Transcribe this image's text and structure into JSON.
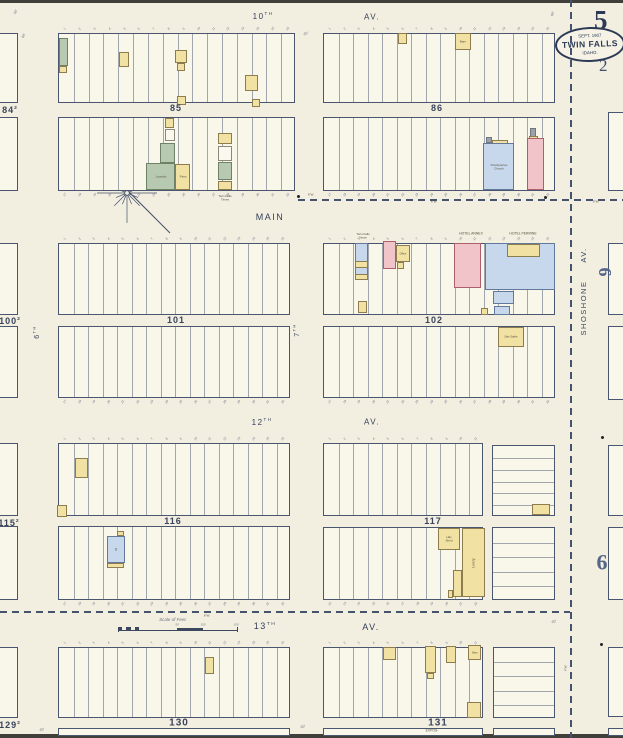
{
  "page": {
    "bg": "#f3efe0",
    "block_fill": "#f9f6ea",
    "ink": "#46536e",
    "sheet_number": "5",
    "secondary_number": "2",
    "badge": {
      "date": "SEPT. 1907",
      "city": "TWIN FALLS",
      "state": "IDAHO."
    }
  },
  "palette": {
    "fills": {
      "yellow": "#f1e2a4",
      "pink": "#f1c4c9",
      "blue": "#c8d8ec",
      "green": "#b8c9b2",
      "white": "#fbf9ef",
      "gray": "#9aa2aa"
    },
    "borders": {
      "yellow": "#8d7c4e",
      "pink": "#ad5f6d",
      "blue": "#62799c",
      "green": "#6f8268",
      "white": "#8a8a7a",
      "gray": "#70777e"
    }
  },
  "streets": [
    {
      "t": "10",
      "sup": "TH",
      "x": 263,
      "y": 17,
      "s": 8
    },
    {
      "t": "AV.",
      "x": 372,
      "y": 18,
      "s": 8
    },
    {
      "t": "MAIN",
      "x": 270,
      "y": 217,
      "s": 9
    },
    {
      "t": "12",
      "sup": "TH",
      "x": 262,
      "y": 423,
      "s": 8
    },
    {
      "t": "AV.",
      "x": 372,
      "y": 423,
      "s": 8
    },
    {
      "t": "13",
      "sup": "TH",
      "x": 265,
      "y": 626,
      "s": 9
    },
    {
      "t": "AV.",
      "x": 371,
      "y": 627,
      "s": 9
    },
    {
      "t": "SHOSHONE",
      "x": 584,
      "y": 308,
      "s": 7.5,
      "r": -90
    },
    {
      "t": "AV.",
      "x": 584,
      "y": 255,
      "s": 7.5,
      "r": -90
    },
    {
      "t": "6",
      "sup": "TH",
      "x": 37,
      "y": 332,
      "s": 7,
      "r": -90
    },
    {
      "t": "7",
      "sup": "TH",
      "x": 297,
      "y": 330,
      "s": 7,
      "r": -90
    }
  ],
  "blocks": [
    {
      "id": "84-sliver-upper",
      "x": -8,
      "y": 33,
      "w": 26,
      "h": 70,
      "lots": 0
    },
    {
      "id": "84-sliver-lower",
      "x": -8,
      "y": 117,
      "w": 26,
      "h": 74,
      "lots": 0
    },
    {
      "id": "85-upper",
      "x": 58,
      "y": 33,
      "w": 237,
      "h": 70,
      "lots": 16,
      "ticks": "top",
      "tickStart": 1
    },
    {
      "id": "85-lower",
      "x": 58,
      "y": 117,
      "w": 237,
      "h": 74,
      "lots": 16,
      "ticks": "bottom",
      "tickStart": 17
    },
    {
      "id": "86-upper",
      "x": 323,
      "y": 33,
      "w": 232,
      "h": 70,
      "lots": 16,
      "ticks": "top",
      "tickStart": 1
    },
    {
      "id": "86-lower",
      "x": 323,
      "y": 117,
      "w": 232,
      "h": 74,
      "lots": 16,
      "ticks": "bottom",
      "tickStart": 17
    },
    {
      "id": "100-sliver-upper",
      "x": -8,
      "y": 243,
      "w": 26,
      "h": 72,
      "lots": 0
    },
    {
      "id": "100-sliver-lower",
      "x": -8,
      "y": 326,
      "w": 26,
      "h": 72,
      "lots": 0
    },
    {
      "id": "101-upper",
      "x": 58,
      "y": 243,
      "w": 232,
      "h": 72,
      "lots": 16,
      "ticks": "top",
      "tickStart": 1
    },
    {
      "id": "101-lower",
      "x": 58,
      "y": 326,
      "w": 232,
      "h": 72,
      "lots": 16,
      "ticks": "bottom",
      "tickStart": 17
    },
    {
      "id": "102-upper",
      "x": 323,
      "y": 243,
      "w": 232,
      "h": 72,
      "lots": 16,
      "ticks": "top",
      "tickStart": 1
    },
    {
      "id": "102-lower",
      "x": 323,
      "y": 326,
      "w": 232,
      "h": 72,
      "lots": 16,
      "ticks": "bottom",
      "tickStart": 17
    },
    {
      "id": "115-sliver-upper",
      "x": -8,
      "y": 443,
      "w": 26,
      "h": 73,
      "lots": 0
    },
    {
      "id": "115-sliver-lower",
      "x": -8,
      "y": 526,
      "w": 26,
      "h": 74,
      "lots": 0
    },
    {
      "id": "116-upper",
      "x": 58,
      "y": 443,
      "w": 232,
      "h": 73,
      "lots": 16,
      "ticks": "top",
      "tickStart": 1
    },
    {
      "id": "116-lower",
      "x": 58,
      "y": 526,
      "w": 232,
      "h": 74,
      "lots": 16,
      "ticks": "bottom",
      "tickStart": 17
    },
    {
      "id": "117-upper-west",
      "x": 323,
      "y": 443,
      "w": 160,
      "h": 73,
      "lots": 11,
      "ticks": "top",
      "tickStart": 1
    },
    {
      "id": "117-upper-east",
      "x": 492,
      "y": 445,
      "w": 63,
      "h": 71,
      "lots": 6,
      "dir": "h"
    },
    {
      "id": "117-lower-west",
      "x": 323,
      "y": 527,
      "w": 160,
      "h": 73,
      "lots": 11,
      "ticks": "bottom",
      "tickStart": 12
    },
    {
      "id": "117-lower-east",
      "x": 492,
      "y": 527,
      "w": 63,
      "h": 73,
      "lots": 5,
      "dir": "h"
    },
    {
      "id": "129-sliver",
      "x": -8,
      "y": 647,
      "w": 26,
      "h": 71,
      "lots": 0
    },
    {
      "id": "130",
      "x": 58,
      "y": 647,
      "w": 232,
      "h": 71,
      "lots": 16,
      "ticks": "top",
      "tickStart": 1
    },
    {
      "id": "130-strip",
      "x": 58,
      "y": 728,
      "w": 232,
      "h": 8,
      "lots": 0
    },
    {
      "id": "131-west",
      "x": 323,
      "y": 647,
      "w": 160,
      "h": 71,
      "lots": 11,
      "ticks": "top",
      "tickStart": 1
    },
    {
      "id": "131-east",
      "x": 493,
      "y": 647,
      "w": 62,
      "h": 71,
      "lots": 5,
      "dir": "h"
    },
    {
      "id": "131-strip-west",
      "x": 323,
      "y": 728,
      "w": 160,
      "h": 8,
      "lots": 0
    },
    {
      "id": "131-strip-east",
      "x": 493,
      "y": 728,
      "w": 62,
      "h": 8,
      "lots": 0
    },
    {
      "id": "east-1",
      "x": 608,
      "y": 112,
      "w": 23,
      "h": 79,
      "lots": 0
    },
    {
      "id": "east-2",
      "x": 608,
      "y": 243,
      "w": 23,
      "h": 72,
      "lots": 0
    },
    {
      "id": "east-3",
      "x": 608,
      "y": 326,
      "w": 23,
      "h": 74,
      "lots": 0
    },
    {
      "id": "east-4",
      "x": 608,
      "y": 445,
      "w": 23,
      "h": 71,
      "lots": 0
    },
    {
      "id": "east-5",
      "x": 608,
      "y": 527,
      "w": 23,
      "h": 73,
      "lots": 0
    },
    {
      "id": "east-6",
      "x": 608,
      "y": 647,
      "w": 23,
      "h": 70,
      "lots": 0
    },
    {
      "id": "east-strip",
      "x": 608,
      "y": 728,
      "w": 23,
      "h": 8,
      "lots": 0
    }
  ],
  "block_labels": [
    {
      "t": "85",
      "x": 176,
      "y": 108,
      "s": 9
    },
    {
      "t": "86",
      "x": 437,
      "y": 108,
      "s": 9
    },
    {
      "t": "101",
      "x": 176,
      "y": 320,
      "s": 9
    },
    {
      "t": "102",
      "x": 434,
      "y": 320,
      "s": 9
    },
    {
      "t": "116",
      "x": 173,
      "y": 521,
      "s": 9
    },
    {
      "t": "117",
      "x": 433,
      "y": 521,
      "s": 9
    },
    {
      "t": "130",
      "x": 179,
      "y": 723,
      "s": 10
    },
    {
      "t": "131",
      "x": 438,
      "y": 723,
      "s": 10
    },
    {
      "t": "84",
      "sub": "2",
      "x": 10,
      "y": 110,
      "s": 9
    },
    {
      "t": "100",
      "sub": "2",
      "x": 10,
      "y": 321,
      "s": 9
    },
    {
      "t": "115",
      "sub": "2",
      "x": 9,
      "y": 523,
      "s": 9
    },
    {
      "t": "129",
      "sub": "2",
      "x": 10,
      "y": 725,
      "s": 9
    },
    {
      "t": "6",
      "x": 605,
      "y": 272,
      "s": 18,
      "r": 90,
      "serif": 1,
      "light": 1
    },
    {
      "t": "6",
      "x": 602,
      "y": 563,
      "s": 22,
      "serif": 1,
      "light": 1
    }
  ],
  "buildings": [
    {
      "x": 59,
      "y": 38,
      "w": 9,
      "h": 28,
      "c": "green"
    },
    {
      "x": 59,
      "y": 66,
      "w": 8,
      "h": 7,
      "c": "yellow"
    },
    {
      "x": 119,
      "y": 52,
      "w": 10,
      "h": 15,
      "c": "yellow"
    },
    {
      "x": 175,
      "y": 50,
      "w": 12,
      "h": 13,
      "c": "yellow"
    },
    {
      "x": 177,
      "y": 63,
      "w": 8,
      "h": 8,
      "c": "yellow"
    },
    {
      "x": 245,
      "y": 75,
      "w": 13,
      "h": 16,
      "c": "yellow"
    },
    {
      "x": 177,
      "y": 96,
      "w": 9,
      "h": 9,
      "c": "yellow",
      "cr": 1
    },
    {
      "x": 252,
      "y": 99,
      "w": 8,
      "h": 8,
      "c": "yellow",
      "cr": 1
    },
    {
      "x": 165,
      "y": 118,
      "w": 9,
      "h": 10,
      "c": "yellow",
      "cr": 1
    },
    {
      "x": 165,
      "y": 129,
      "w": 10,
      "h": 12,
      "c": "white"
    },
    {
      "x": 160,
      "y": 143,
      "w": 15,
      "h": 20,
      "c": "green"
    },
    {
      "x": 146,
      "y": 163,
      "w": 29,
      "h": 27,
      "c": "green",
      "lb": "Laundry",
      "ls": 3
    },
    {
      "x": 175,
      "y": 164,
      "w": 15,
      "h": 26,
      "c": "yellow",
      "lb": "Paint",
      "ls": 3
    },
    {
      "x": 218,
      "y": 133,
      "w": 14,
      "h": 11,
      "c": "yellow"
    },
    {
      "x": 218,
      "y": 146,
      "w": 14,
      "h": 15,
      "c": "white"
    },
    {
      "x": 218,
      "y": 162,
      "w": 14,
      "h": 18,
      "c": "green"
    },
    {
      "x": 218,
      "y": 181,
      "w": 14,
      "h": 9,
      "c": "yellow"
    },
    {
      "x": 398,
      "y": 33,
      "w": 9,
      "h": 11,
      "c": "yellow"
    },
    {
      "x": 455,
      "y": 33,
      "w": 16,
      "h": 17,
      "c": "yellow",
      "lb": "Barn",
      "ls": 3
    },
    {
      "x": 486,
      "y": 137,
      "w": 6,
      "h": 6,
      "c": "gray"
    },
    {
      "x": 492,
      "y": 140,
      "w": 16,
      "h": 4,
      "c": "yellow"
    },
    {
      "x": 483,
      "y": 143,
      "w": 31,
      "h": 47,
      "c": "blue",
      "lb": "Presbyterian\nChurch",
      "ls": 3
    },
    {
      "x": 530,
      "y": 128,
      "w": 6,
      "h": 10,
      "c": "gray"
    },
    {
      "x": 529,
      "y": 136,
      "w": 9,
      "h": 4,
      "c": "yellow"
    },
    {
      "x": 527,
      "y": 138,
      "w": 17,
      "h": 52,
      "c": "pink"
    },
    {
      "x": 355,
      "y": 243,
      "w": 13,
      "h": 36,
      "c": "blue"
    },
    {
      "x": 355,
      "y": 261,
      "w": 13,
      "h": 7,
      "c": "yellow"
    },
    {
      "x": 355,
      "y": 274,
      "w": 13,
      "h": 6,
      "c": "yellow"
    },
    {
      "x": 358,
      "y": 301,
      "w": 9,
      "h": 12,
      "c": "yellow"
    },
    {
      "x": 383,
      "y": 241,
      "w": 13,
      "h": 28,
      "c": "pink"
    },
    {
      "x": 396,
      "y": 245,
      "w": 14,
      "h": 17,
      "c": "yellow",
      "lb": "Office",
      "ls": 2.6
    },
    {
      "x": 397,
      "y": 262,
      "w": 7,
      "h": 7,
      "c": "yellow"
    },
    {
      "x": 454,
      "y": 243,
      "w": 27,
      "h": 45,
      "c": "pink"
    },
    {
      "x": 485,
      "y": 243,
      "w": 70,
      "h": 47,
      "c": "blue"
    },
    {
      "x": 507,
      "y": 244,
      "w": 33,
      "h": 13,
      "c": "yellow"
    },
    {
      "x": 493,
      "y": 291,
      "w": 21,
      "h": 13,
      "c": "blue"
    },
    {
      "x": 494,
      "y": 306,
      "w": 16,
      "h": 9,
      "c": "blue"
    },
    {
      "x": 481,
      "y": 308,
      "w": 7,
      "h": 7,
      "c": "yellow"
    },
    {
      "x": 498,
      "y": 327,
      "w": 26,
      "h": 20,
      "c": "yellow",
      "lb": "Sale Stable",
      "ls": 2.6
    },
    {
      "x": 75,
      "y": 458,
      "w": 13,
      "h": 20,
      "c": "yellow"
    },
    {
      "x": 57,
      "y": 505,
      "w": 10,
      "h": 12,
      "c": "yellow",
      "cr": 1
    },
    {
      "x": 117,
      "y": 531,
      "w": 7,
      "h": 5,
      "c": "yellow"
    },
    {
      "x": 107,
      "y": 536,
      "w": 18,
      "h": 27,
      "c": "blue",
      "lb": "D",
      "ls": 3.5
    },
    {
      "x": 107,
      "y": 563,
      "w": 17,
      "h": 5,
      "c": "yellow"
    },
    {
      "x": 532,
      "y": 504,
      "w": 18,
      "h": 11,
      "c": "yellow"
    },
    {
      "x": 438,
      "y": 528,
      "w": 22,
      "h": 22,
      "c": "yellow",
      "lb": "Hay\nShed",
      "ls": 3
    },
    {
      "x": 462,
      "y": 528,
      "w": 23,
      "h": 69,
      "c": "yellow",
      "cr": 1,
      "lb": "Livery",
      "ls": 3.5,
      "lr": -90
    },
    {
      "x": 453,
      "y": 570,
      "w": 9,
      "h": 27,
      "c": "yellow"
    },
    {
      "x": 448,
      "y": 590,
      "w": 5,
      "h": 8,
      "c": "yellow"
    },
    {
      "x": 205,
      "y": 657,
      "w": 9,
      "h": 17,
      "c": "yellow"
    },
    {
      "x": 383,
      "y": 647,
      "w": 13,
      "h": 13,
      "c": "yellow"
    },
    {
      "x": 425,
      "y": 646,
      "w": 11,
      "h": 27,
      "c": "yellow",
      "cr": 1
    },
    {
      "x": 427,
      "y": 673,
      "w": 7,
      "h": 6,
      "c": "yellow"
    },
    {
      "x": 446,
      "y": 646,
      "w": 10,
      "h": 17,
      "c": "yellow",
      "cr": 1
    },
    {
      "x": 468,
      "y": 645,
      "w": 13,
      "h": 15,
      "c": "yellow",
      "lb": "Barn",
      "ls": 2.6
    },
    {
      "x": 467,
      "y": 702,
      "w": 14,
      "h": 16,
      "c": "yellow"
    }
  ],
  "annotations": [
    {
      "t": "Twin Falls\nTimes",
      "x": 225,
      "y": 198,
      "s": 3
    },
    {
      "t": "Twin Falls\nNews",
      "x": 363,
      "y": 236,
      "s": 3
    },
    {
      "t": "HOTEL ANNEX",
      "x": 471,
      "y": 234,
      "s": 3.4
    },
    {
      "t": "HOTEL PERRINE",
      "x": 523,
      "y": 234,
      "s": 3.4
    },
    {
      "t": "6\"W.",
      "x": 311,
      "y": 195,
      "s": 3
    },
    {
      "t": "6\"W.",
      "x": 434,
      "y": 202,
      "s": 3
    },
    {
      "t": "6\"W.",
      "x": 596,
      "y": 202,
      "s": 3
    },
    {
      "t": "6\"W.",
      "x": 207,
      "y": 616,
      "s": 3
    },
    {
      "t": "4\"W.",
      "x": 566,
      "y": 668,
      "s": 3,
      "r": -90
    },
    {
      "t": "50'",
      "x": 16,
      "y": 12,
      "s": 3.6,
      "r": -65,
      "i": 1
    },
    {
      "t": "60'",
      "x": 24,
      "y": 36,
      "s": 3.6,
      "r": -60,
      "i": 1
    },
    {
      "t": "60'",
      "x": 306,
      "y": 34,
      "s": 3.6,
      "r": -20,
      "i": 1
    },
    {
      "t": "60'",
      "x": 553,
      "y": 14,
      "s": 3.6,
      "r": -65,
      "i": 1
    },
    {
      "t": "60'",
      "x": 303,
      "y": 727,
      "s": 3.6,
      "r": -15,
      "i": 1
    },
    {
      "t": "60'",
      "x": 42,
      "y": 730,
      "s": 3.6,
      "r": -15,
      "i": 1
    },
    {
      "t": "60'",
      "x": 554,
      "y": 622,
      "s": 3.6,
      "r": -15,
      "i": 1
    },
    {
      "t": "EXPOS-",
      "x": 432,
      "y": 731,
      "s": 3.4
    }
  ],
  "dashes": [
    {
      "dir": "v",
      "x": 570,
      "y": 0,
      "len": 738
    },
    {
      "dir": "h",
      "x": 298,
      "y": 199,
      "len": 325
    },
    {
      "dir": "h",
      "x": 0,
      "y": 611,
      "len": 570
    }
  ],
  "dots": [
    {
      "x": 298,
      "y": 196
    },
    {
      "x": 545,
      "y": 197
    },
    {
      "x": 602,
      "y": 437
    },
    {
      "x": 601,
      "y": 644
    }
  ],
  "scale_bar": {
    "title": "Scale of Feet.",
    "ticks": [
      {
        "t": "50",
        "x": 177
      },
      {
        "t": "100",
        "x": 203
      },
      {
        "t": "150",
        "x": 236
      }
    ]
  }
}
